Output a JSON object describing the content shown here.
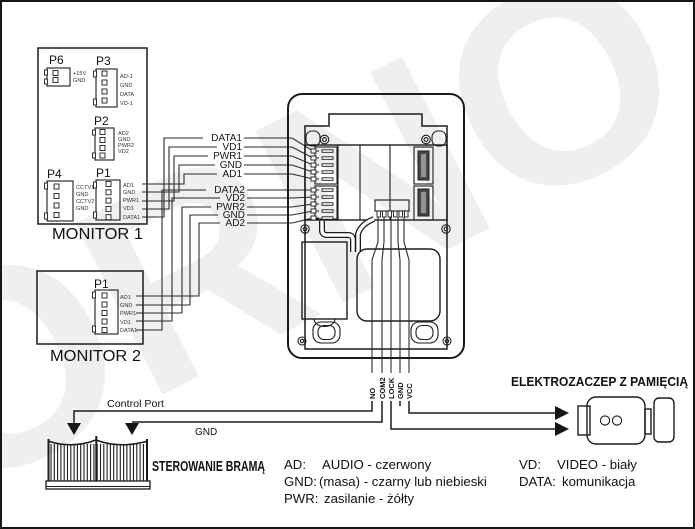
{
  "watermark": "ORNO",
  "monitor1": {
    "title": "MONITOR 1",
    "connectors": {
      "p6": {
        "name": "P6",
        "pins": [
          "+15V",
          "GND"
        ]
      },
      "p3": {
        "name": "P3",
        "pins": [
          "AD-1",
          "GND",
          "DATA",
          "VD-1"
        ]
      },
      "p2": {
        "name": "P2",
        "pins": [
          "AD2",
          "GND",
          "PWR2",
          "VD2"
        ]
      },
      "p4": {
        "name": "P4",
        "pins": [
          "CCTV1",
          "GND",
          "CCTV2",
          "GND"
        ]
      },
      "p1": {
        "name": "P1",
        "pins": [
          "AD1",
          "GND",
          "PWR1",
          "VD1",
          "DATA1"
        ]
      }
    }
  },
  "monitor2": {
    "title": "MONITOR 2",
    "connectors": {
      "p1": {
        "name": "P1",
        "pins": [
          "AD1",
          "GND",
          "PWR1",
          "VD1",
          "DATA1"
        ]
      }
    }
  },
  "bus1": {
    "labels": [
      "DATA1",
      "VD1",
      "PWR1",
      "GND",
      "AD1"
    ]
  },
  "bus2": {
    "labels": [
      "DATA2",
      "VD2",
      "PWR2",
      "GND",
      "AD2"
    ]
  },
  "door_station": {
    "terminals": [
      "NO",
      "COM2",
      "LOCK",
      "GND",
      "VCC"
    ]
  },
  "gate": {
    "title": "STEROWANIE BRAMĄ",
    "lines": {
      "control": "Control Port",
      "gnd": "GND"
    }
  },
  "strike": {
    "title": "ELEKTROZACZEP Z PAMIĘCIĄ"
  },
  "legend": {
    "left": [
      {
        "term": "AD:",
        "desc": "AUDIO - czerwony"
      },
      {
        "term": "GND:",
        "desc": "(masa) - czarny lub niebieski"
      },
      {
        "term": "PWR:",
        "desc": "zasilanie  - żółty"
      }
    ],
    "right": [
      {
        "term": "VD:",
        "desc": "VIDEO - biały"
      },
      {
        "term": "DATA:",
        "desc": "komunikacja"
      }
    ]
  }
}
